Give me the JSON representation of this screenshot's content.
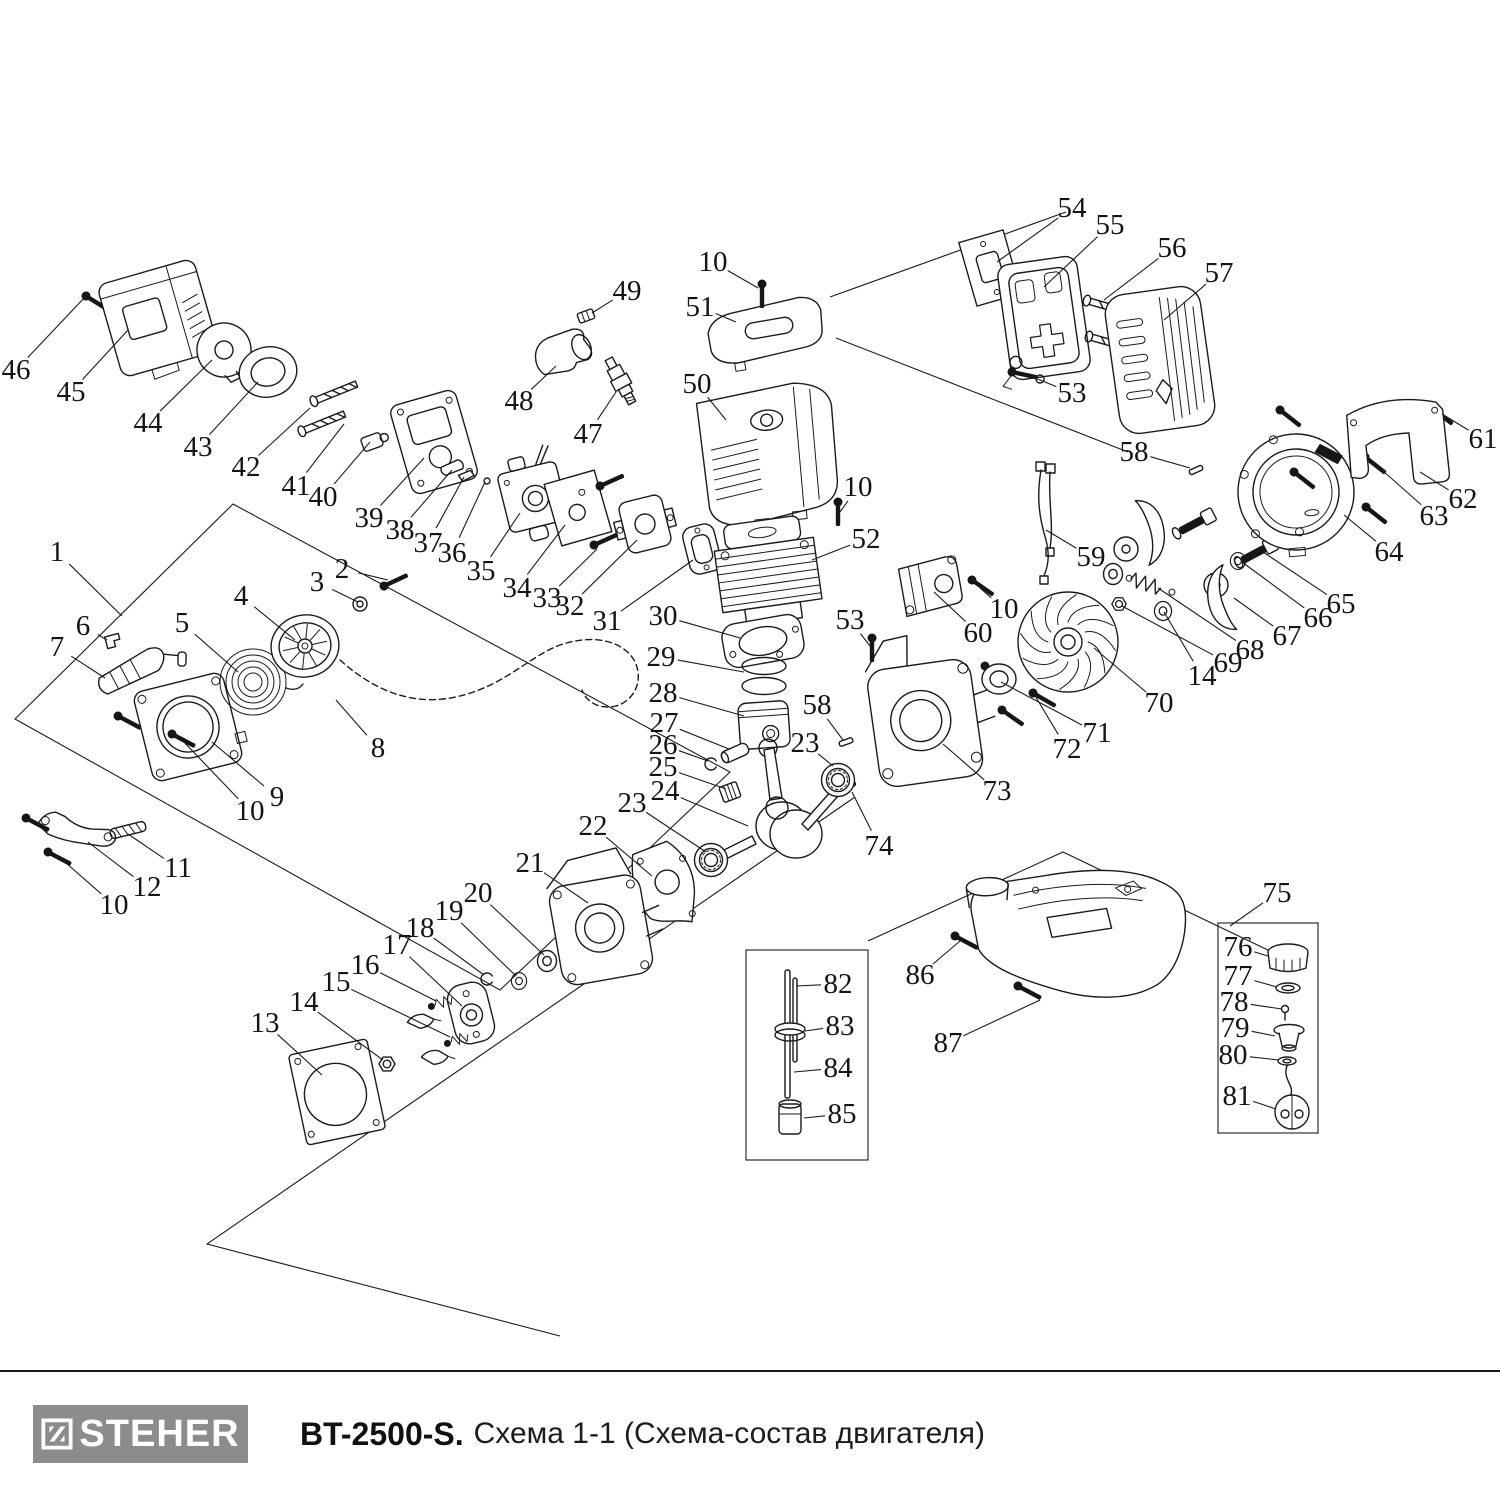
{
  "footer": {
    "brand": "STEHER",
    "model": "BT-2500-S.",
    "subtitle": "Схема 1-1 (Схема-состав двигателя)"
  },
  "diagram": {
    "labels": [
      {
        "n": "1",
        "x": 57,
        "y": 552,
        "ex": 122,
        "ey": 616
      },
      {
        "n": "2",
        "x": 342,
        "y": 569,
        "ex": 388,
        "ey": 580
      },
      {
        "n": "3",
        "x": 317,
        "y": 582,
        "ex": 358,
        "ey": 602
      },
      {
        "n": "4",
        "x": 241,
        "y": 596,
        "ex": 295,
        "ey": 640
      },
      {
        "n": "5",
        "x": 182,
        "y": 623,
        "ex": 238,
        "ey": 672
      },
      {
        "n": "6",
        "x": 83,
        "y": 626,
        "ex": 107,
        "ey": 640
      },
      {
        "n": "7",
        "x": 57,
        "y": 647,
        "ex": 105,
        "ey": 678
      },
      {
        "n": "8",
        "x": 378,
        "y": 748,
        "ex": 336,
        "ey": 700
      },
      {
        "n": "9",
        "x": 277,
        "y": 797,
        "ex": 212,
        "ey": 742
      },
      {
        "n": "10",
        "x": 250,
        "y": 811,
        "ex": 182,
        "ey": 740
      },
      {
        "n": "11",
        "x": 178,
        "y": 868,
        "ex": 128,
        "ey": 834
      },
      {
        "n": "12",
        "x": 147,
        "y": 887,
        "ex": 88,
        "ey": 842
      },
      {
        "n": "10",
        "x": 114,
        "y": 905,
        "ex": 58,
        "ey": 856
      },
      {
        "n": "13",
        "x": 265,
        "y": 1023,
        "ex": 322,
        "ey": 1075
      },
      {
        "n": "14",
        "x": 304,
        "y": 1002,
        "ex": 383,
        "ey": 1060
      },
      {
        "n": "15",
        "x": 336,
        "y": 982,
        "ex": 450,
        "ey": 1037
      },
      {
        "n": "16",
        "x": 365,
        "y": 965,
        "ex": 436,
        "ey": 1001
      },
      {
        "n": "17",
        "x": 397,
        "y": 945,
        "ex": 462,
        "ey": 1006
      },
      {
        "n": "18",
        "x": 420,
        "y": 928,
        "ex": 484,
        "ey": 975
      },
      {
        "n": "19",
        "x": 449,
        "y": 911,
        "ex": 516,
        "ey": 976
      },
      {
        "n": "20",
        "x": 478,
        "y": 893,
        "ex": 544,
        "ey": 955
      },
      {
        "n": "21",
        "x": 530,
        "y": 863,
        "ex": 588,
        "ey": 903
      },
      {
        "n": "22",
        "x": 593,
        "y": 826,
        "ex": 652,
        "ey": 876
      },
      {
        "n": "23",
        "x": 632,
        "y": 803,
        "ex": 706,
        "ey": 852
      },
      {
        "n": "24",
        "x": 665,
        "y": 791,
        "ex": 748,
        "ey": 826
      },
      {
        "n": "25",
        "x": 663,
        "y": 767,
        "ex": 726,
        "ey": 789
      },
      {
        "n": "26",
        "x": 663,
        "y": 745,
        "ex": 708,
        "ey": 761
      },
      {
        "n": "27",
        "x": 664,
        "y": 723,
        "ex": 729,
        "ey": 749
      },
      {
        "n": "28",
        "x": 663,
        "y": 693,
        "ex": 744,
        "ey": 716
      },
      {
        "n": "29",
        "x": 661,
        "y": 657,
        "ex": 744,
        "ey": 672
      },
      {
        "n": "30",
        "x": 663,
        "y": 616,
        "ex": 740,
        "ey": 638
      },
      {
        "n": "31",
        "x": 607,
        "y": 621,
        "ex": 693,
        "ey": 560
      },
      {
        "n": "32",
        "x": 570,
        "y": 606,
        "ex": 637,
        "ey": 540
      },
      {
        "n": "33",
        "x": 547,
        "y": 598,
        "ex": 597,
        "ey": 549
      },
      {
        "n": "34",
        "x": 517,
        "y": 588,
        "ex": 565,
        "ey": 525
      },
      {
        "n": "35",
        "x": 481,
        "y": 571,
        "ex": 520,
        "ey": 513
      },
      {
        "n": "36",
        "x": 452,
        "y": 553,
        "ex": 485,
        "ey": 482
      },
      {
        "n": "37",
        "x": 428,
        "y": 543,
        "ex": 464,
        "ey": 477
      },
      {
        "n": "38",
        "x": 400,
        "y": 530,
        "ex": 452,
        "ey": 470
      },
      {
        "n": "39",
        "x": 369,
        "y": 518,
        "ex": 424,
        "ey": 458
      },
      {
        "n": "40",
        "x": 323,
        "y": 497,
        "ex": 370,
        "ey": 442
      },
      {
        "n": "41",
        "x": 296,
        "y": 486,
        "ex": 344,
        "ey": 424
      },
      {
        "n": "42",
        "x": 246,
        "y": 467,
        "ex": 310,
        "ey": 408
      },
      {
        "n": "43",
        "x": 198,
        "y": 447,
        "ex": 258,
        "ey": 382
      },
      {
        "n": "44",
        "x": 148,
        "y": 423,
        "ex": 212,
        "ey": 360
      },
      {
        "n": "45",
        "x": 71,
        "y": 392,
        "ex": 128,
        "ey": 330
      },
      {
        "n": "46",
        "x": 16,
        "y": 370,
        "ex": 86,
        "ey": 296
      },
      {
        "n": "47",
        "x": 588,
        "y": 434,
        "ex": 616,
        "ey": 392
      },
      {
        "n": "48",
        "x": 519,
        "y": 401,
        "ex": 556,
        "ey": 366
      },
      {
        "n": "49",
        "x": 627,
        "y": 291,
        "ex": 592,
        "ey": 313
      },
      {
        "n": "50",
        "x": 697,
        "y": 384,
        "ex": 726,
        "ey": 420
      },
      {
        "n": "51",
        "x": 700,
        "y": 307,
        "ex": 736,
        "ey": 322
      },
      {
        "n": "10",
        "x": 713,
        "y": 262,
        "ex": 758,
        "ey": 288
      },
      {
        "n": "52",
        "x": 866,
        "y": 539,
        "ex": 812,
        "ey": 560
      },
      {
        "n": "10",
        "x": 858,
        "y": 487,
        "ex": 840,
        "ey": 512
      },
      {
        "n": "53",
        "x": 850,
        "y": 620,
        "ex": 870,
        "ey": 646
      },
      {
        "n": "58",
        "x": 817,
        "y": 705,
        "ex": 843,
        "ey": 740
      },
      {
        "n": "23",
        "x": 805,
        "y": 743,
        "ex": 833,
        "ey": 766
      },
      {
        "n": "74",
        "x": 879,
        "y": 846,
        "ex": 852,
        "ey": 792
      },
      {
        "n": "73",
        "x": 997,
        "y": 791,
        "ex": 943,
        "ey": 744
      },
      {
        "n": "54",
        "x": 1072,
        "y": 208,
        "ex": 997,
        "ey": 262
      },
      {
        "n": "55",
        "x": 1110,
        "y": 225,
        "ex": 1044,
        "ey": 287
      },
      {
        "n": "56",
        "x": 1172,
        "y": 248,
        "ex": 1104,
        "ey": 300
      },
      {
        "n": "57",
        "x": 1219,
        "y": 273,
        "ex": 1164,
        "ey": 320
      },
      {
        "n": "53",
        "x": 1072,
        "y": 393,
        "ex": 1030,
        "ey": 376
      },
      {
        "n": "58",
        "x": 1134,
        "y": 452,
        "ex": 1190,
        "ey": 468
      },
      {
        "n": "59",
        "x": 1091,
        "y": 557,
        "ex": 1046,
        "ey": 530
      },
      {
        "n": "60",
        "x": 978,
        "y": 633,
        "ex": 934,
        "ey": 592
      },
      {
        "n": "10",
        "x": 1004,
        "y": 609,
        "ex": 980,
        "ey": 588
      },
      {
        "n": "61",
        "x": 1483,
        "y": 439,
        "ex": 1442,
        "ey": 414
      },
      {
        "n": "62",
        "x": 1463,
        "y": 499,
        "ex": 1420,
        "ey": 472
      },
      {
        "n": "63",
        "x": 1434,
        "y": 516,
        "ex": 1374,
        "ey": 463
      },
      {
        "n": "64",
        "x": 1389,
        "y": 552,
        "ex": 1344,
        "ey": 515
      },
      {
        "n": "65",
        "x": 1341,
        "y": 604,
        "ex": 1263,
        "ey": 552
      },
      {
        "n": "66",
        "x": 1318,
        "y": 618,
        "ex": 1242,
        "ey": 562
      },
      {
        "n": "67",
        "x": 1287,
        "y": 636,
        "ex": 1234,
        "ey": 598
      },
      {
        "n": "68",
        "x": 1250,
        "y": 650,
        "ex": 1158,
        "ey": 588
      },
      {
        "n": "69",
        "x": 1228,
        "y": 663,
        "ex": 1122,
        "ey": 606
      },
      {
        "n": "14",
        "x": 1202,
        "y": 676,
        "ex": 1164,
        "ey": 612
      },
      {
        "n": "70",
        "x": 1159,
        "y": 703,
        "ex": 1094,
        "ey": 648
      },
      {
        "n": "71",
        "x": 1097,
        "y": 733,
        "ex": 1001,
        "ey": 682
      },
      {
        "n": "72",
        "x": 1067,
        "y": 749,
        "ex": 1034,
        "ey": 694
      },
      {
        "n": "75",
        "x": 1277,
        "y": 893,
        "ex": 1230,
        "ey": 926
      },
      {
        "n": "76",
        "x": 1238,
        "y": 947,
        "ex": 1268,
        "ey": 956
      },
      {
        "n": "77",
        "x": 1238,
        "y": 976,
        "ex": 1277,
        "ey": 987
      },
      {
        "n": "78",
        "x": 1234,
        "y": 1002,
        "ex": 1282,
        "ey": 1009
      },
      {
        "n": "79",
        "x": 1235,
        "y": 1028,
        "ex": 1275,
        "ey": 1036
      },
      {
        "n": "80",
        "x": 1233,
        "y": 1055,
        "ex": 1279,
        "ey": 1060
      },
      {
        "n": "81",
        "x": 1237,
        "y": 1096,
        "ex": 1276,
        "ey": 1109
      },
      {
        "n": "82",
        "x": 838,
        "y": 984,
        "ex": 796,
        "ey": 986
      },
      {
        "n": "83",
        "x": 840,
        "y": 1026,
        "ex": 805,
        "ey": 1031
      },
      {
        "n": "84",
        "x": 838,
        "y": 1068,
        "ex": 794,
        "ey": 1072
      },
      {
        "n": "85",
        "x": 842,
        "y": 1114,
        "ex": 804,
        "ey": 1118
      },
      {
        "n": "86",
        "x": 920,
        "y": 975,
        "ex": 960,
        "ey": 941
      },
      {
        "n": "87",
        "x": 948,
        "y": 1043,
        "ex": 1040,
        "ey": 1000
      }
    ]
  }
}
